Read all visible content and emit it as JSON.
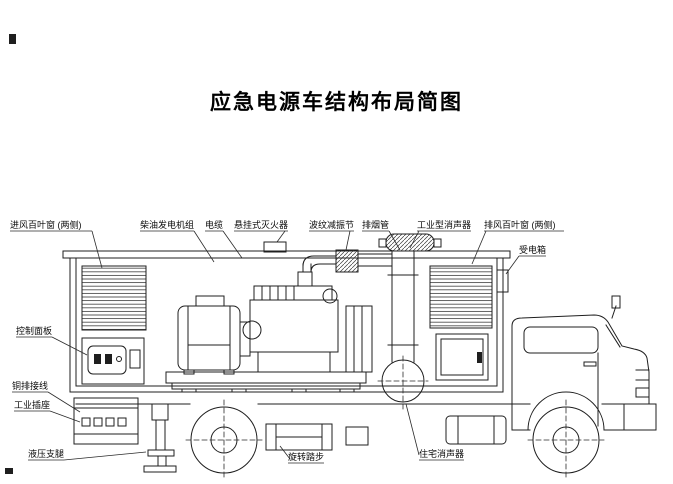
{
  "title": "应急电源车结构布局简图",
  "colors": {
    "background": "#ffffff",
    "line": "#1f1f1f"
  },
  "diagram": {
    "labels": {
      "intake_louver": "进风百叶窗 (两侧)",
      "diesel_generator_set": "柴油发电机组",
      "cable": "电缆",
      "hanging_fire_extinguisher": "悬挂式灭火器",
      "bellows_damping_joint": "波纹减振节",
      "exhaust_pipe": "排烟管",
      "industrial_muffler": "工业型消声器",
      "exhaust_louver": "排风百叶窗 (两侧)",
      "power_receiving_box": "受电箱",
      "control_panel": "控制面板",
      "busbar_wiring": "铜排接线",
      "industrial_socket": "工业插座",
      "hydraulic_outrigger": "液压支腿",
      "rotating_step": "旋转踏步",
      "residential_muffler": "住宅消声器"
    }
  }
}
